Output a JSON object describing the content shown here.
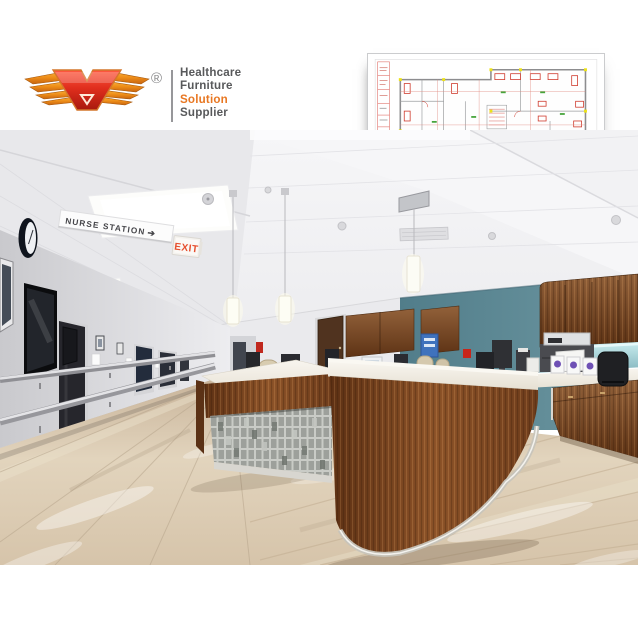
{
  "page": {
    "title": "Healthcare Furniture Solution Supplier"
  },
  "header": {
    "logo": {
      "registered_mark": "®",
      "line1": "Healthcare",
      "line2": "Furniture",
      "line3": "Solution",
      "line4": "Supplier",
      "accent_color": "#e87722",
      "text_color": "#58595b"
    }
  },
  "photo": {
    "signs": {
      "nurse_station_text": "NURSE STATION",
      "nurse_station_arrow": "➔",
      "exit_text": "EXIT"
    },
    "colors": {
      "teal_wall": "#5f8b96",
      "wood_cabinet": "#7b4a27",
      "floor_wood": "#dcc9ae",
      "exit_red": "#e64f2e",
      "counter": "#f5f2ec"
    }
  }
}
